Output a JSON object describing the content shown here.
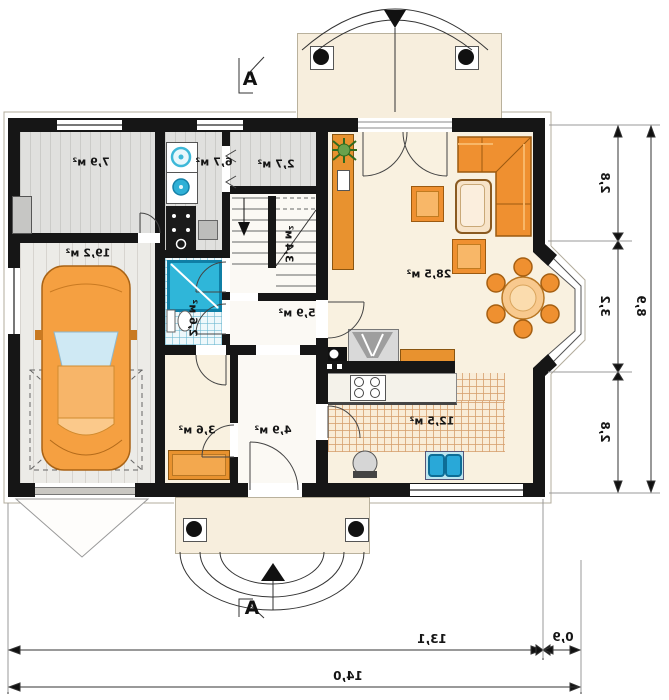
{
  "rooms": {
    "vestibule": {
      "area": "7,9 м²"
    },
    "garage": {
      "area": "19,2 м²"
    },
    "utility": {
      "area": "6,7 м²"
    },
    "closet": {
      "area": "2,7 м²"
    },
    "stairs": {
      "area": "3,4 м²"
    },
    "hall": {
      "area": "5,9 м²"
    },
    "wc": {
      "area": "2,6 м²"
    },
    "storage": {
      "area": "3,6 м²"
    },
    "hallway": {
      "area": "4,9 м²"
    },
    "kitchen": {
      "area": "12,5 м²"
    },
    "living_room": {
      "area": "28,5 м²"
    }
  },
  "dimensions": {
    "right_segments": [
      "2,8",
      "3,2",
      "2,8"
    ],
    "right_total": "8,9",
    "bottom_segments": [
      "13,1",
      "0,9"
    ],
    "bottom_total": "14,0"
  },
  "section_marks": {
    "top": "A",
    "bottom": "A"
  },
  "palette": {
    "wall": "#161616",
    "furniture_orange": "#ef9030",
    "water_blue": "#2fb6d9",
    "floor_cream": "#f9f1e0",
    "tile_line": "#d6a06e"
  }
}
